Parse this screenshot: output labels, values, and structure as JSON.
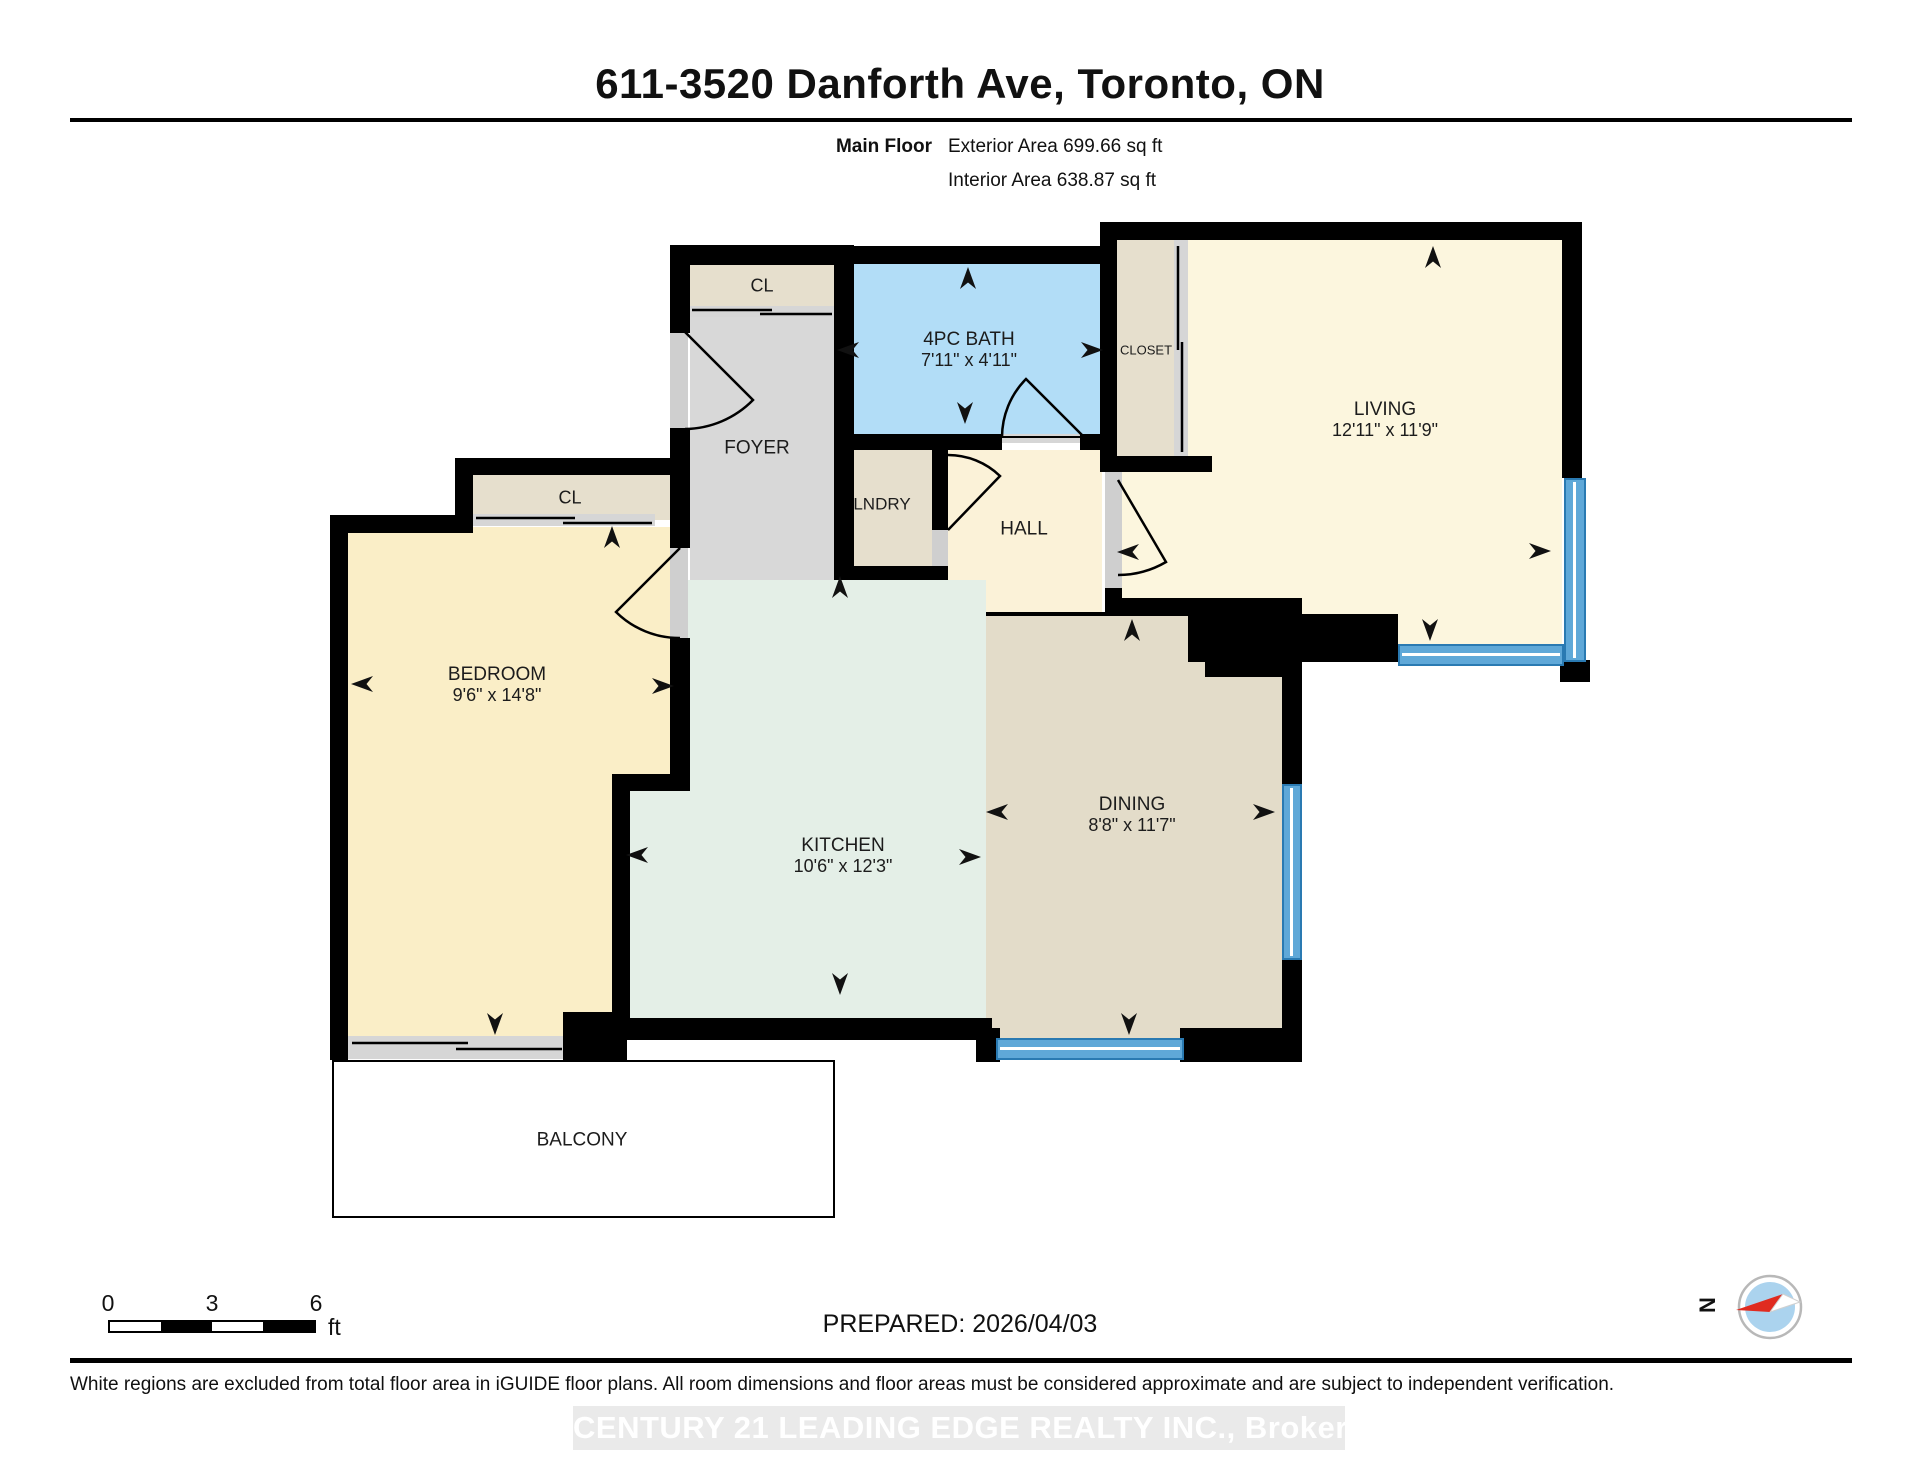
{
  "header": {
    "title": "611-3520 Danforth Ave, Toronto, ON",
    "floor_label": "Main Floor",
    "exterior_area": "Exterior Area 699.66 sq ft",
    "interior_area": "Interior Area 638.87 sq ft"
  },
  "plan": {
    "rooms": {
      "entry_closet": {
        "label": "CL"
      },
      "foyer": {
        "label": "FOYER"
      },
      "bath": {
        "label": "4PC BATH",
        "dims": "7'11\" x 4'11\""
      },
      "closet": {
        "label": "CLOSET"
      },
      "living": {
        "label": "LIVING",
        "dims": "12'11\" x 11'9\""
      },
      "laundry": {
        "label": "LNDRY"
      },
      "hall": {
        "label": "HALL"
      },
      "bedroom_closet": {
        "label": "CL"
      },
      "bedroom": {
        "label": "BEDROOM",
        "dims": "9'6\" x 14'8\""
      },
      "kitchen": {
        "label": "KITCHEN",
        "dims": "10'6\" x 12'3\""
      },
      "dining": {
        "label": "DINING",
        "dims": "8'8\" x 11'7\""
      },
      "balcony": {
        "label": "BALCONY"
      }
    }
  },
  "scale_bar": {
    "tick_start": "0",
    "tick_mid": "3",
    "tick_end": "6",
    "unit": "ft"
  },
  "footer": {
    "prepared_label": "PREPARED: 2026/04/03",
    "compass_north_label": "N",
    "disclaimer": "White regions are excluded from total floor area in iGUIDE floor plans. All room dimensions and floor areas must be considered approximate and are subject to independent verification.",
    "watermark": "CENTURY 21 LEADING EDGE REALTY INC., Brokerage"
  },
  "colors": {
    "wall": "#000000",
    "bath_blue": "#b2ddf7",
    "window_blue": "#5fa8d8",
    "living_cream": "#fcf6de",
    "hall_cream": "#fbf2d8",
    "bedroom_cream": "#faeec7",
    "closet_tan": "#e6dfcd",
    "dining_tan": "#e3dcc9",
    "kitchen_mint": "#e4efe7",
    "foyer_gray": "#d8d8d8",
    "compass_red": "#e02b20"
  }
}
